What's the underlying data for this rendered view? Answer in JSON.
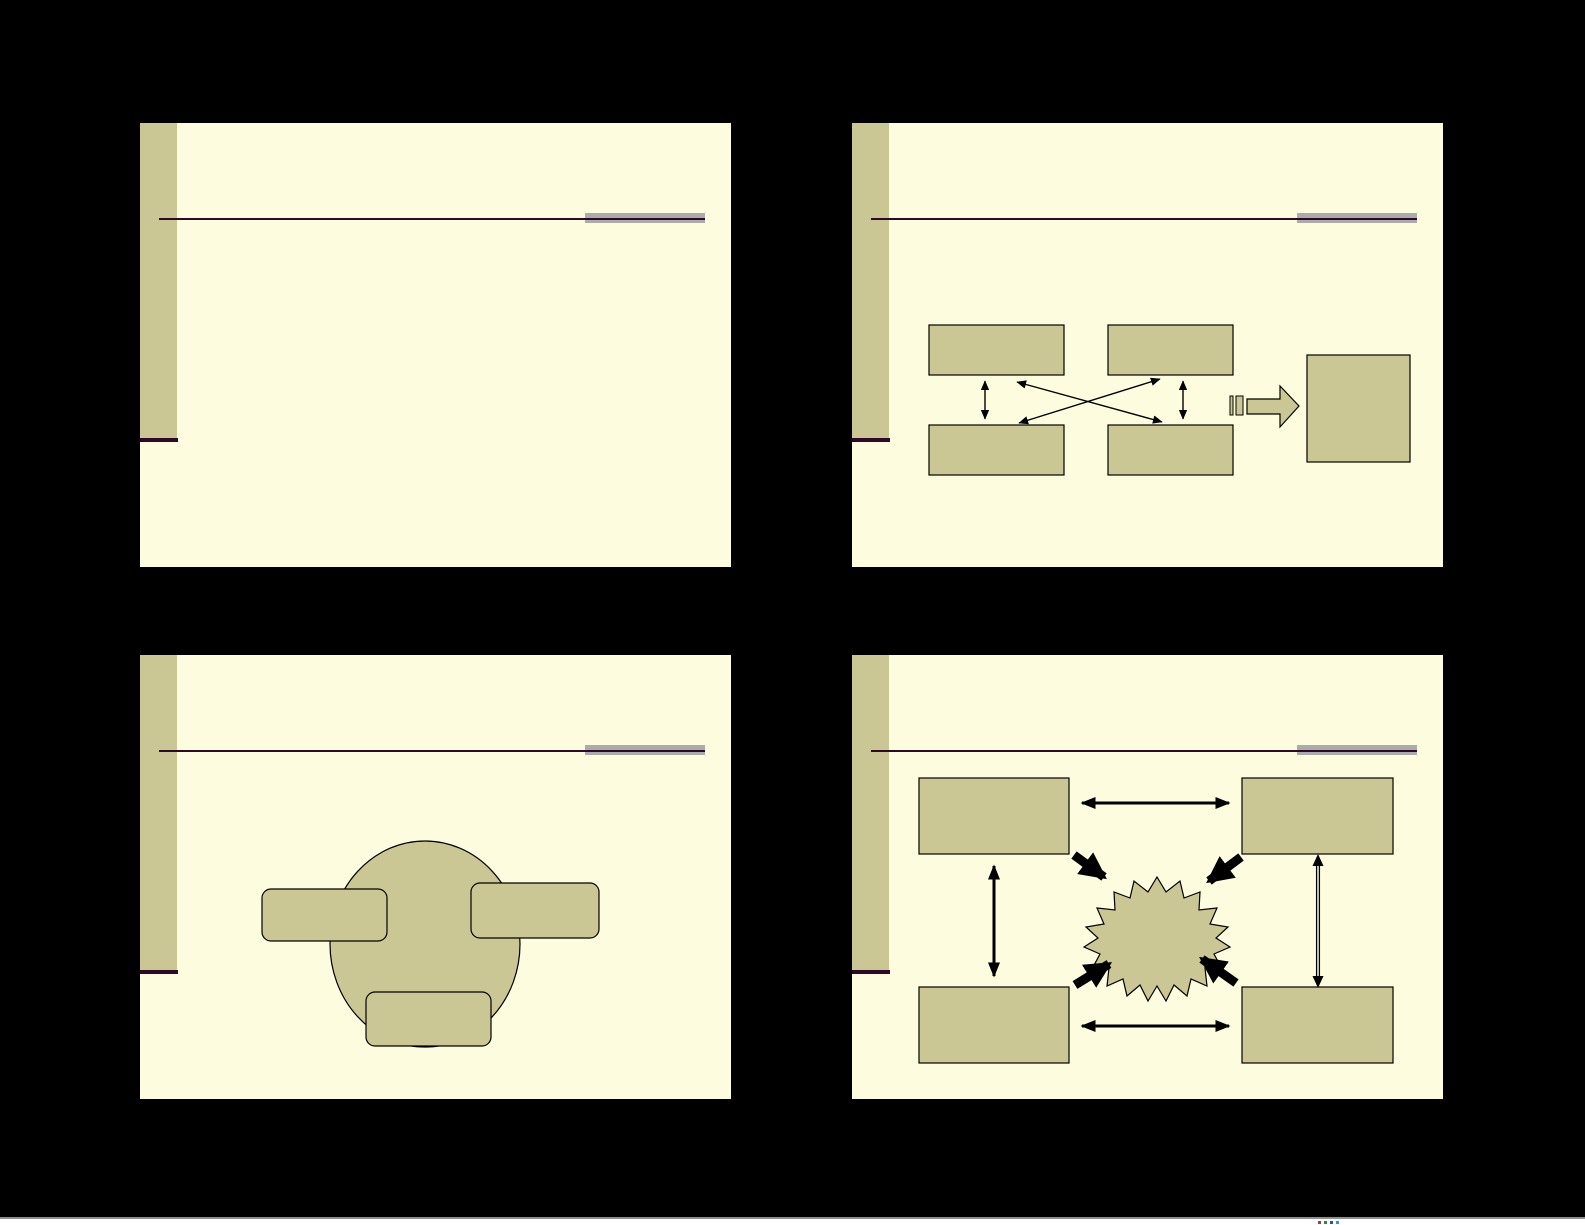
{
  "document": {
    "type": "presentation-handout",
    "slides_per_page": 4,
    "visible_text": ""
  },
  "theme": {
    "page_bg": "#000000",
    "slide_bg": "#FDFCDE",
    "slide_border": "#000000",
    "band_olive": "#CBC795",
    "accent_plum": "#2E0828",
    "gray_bar": "#ABABAB",
    "shape_fill": "#CBC795",
    "shape_stroke": "#000000",
    "footer_line": "#8F8F8F",
    "footer_strip": "#FFFFFF"
  },
  "slides": [
    {
      "id": "slide-1",
      "diagram": "empty-template"
    },
    {
      "id": "slide-2",
      "diagram": "four-boxes-crossed-arrows-striped-arrow-to-square",
      "shapes": {
        "boxes": 4,
        "double_arrows": 4,
        "striped_arrow": 1,
        "square": 1
      }
    },
    {
      "id": "slide-3",
      "diagram": "circle-with-three-rounded-rectangles",
      "shapes": {
        "circle": 1,
        "rounded_rects": 3
      }
    },
    {
      "id": "slide-4",
      "diagram": "four-rects-double-arrows-central-starburst",
      "shapes": {
        "rects": 4,
        "double_arrows": 4,
        "thick_arrows": 4,
        "starburst": 1
      }
    }
  ],
  "footer": {
    "mark_colors": [
      "#b03a2e",
      "#2e8b3a",
      "#2e4fb0",
      "#2ea0a0"
    ]
  }
}
